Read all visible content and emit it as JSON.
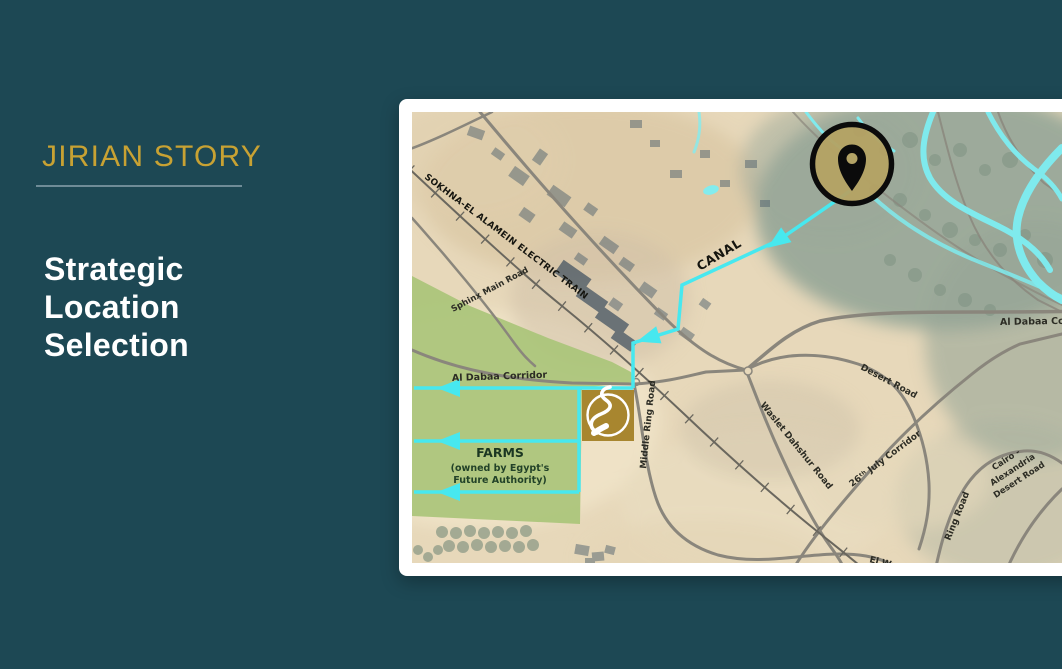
{
  "slide": {
    "kicker": "JIRIAN STORY",
    "title": "Strategic Location Selection"
  },
  "map": {
    "roads": {
      "railway": "SOKHNA-EL ALAMEIN ELECTRIC TRAIN",
      "sphinx": "Sphinx Main Road",
      "al_dabaa_mid": "Al Dabaa Corridor",
      "al_dabaa_right": "Al Dabaa Corridor",
      "middle_ring": "Middle Ring Road",
      "desert": "Desert Road",
      "waslet": "Waslet Dahshur Road",
      "july26": "26ᵗʰ July Corridor",
      "ring": "Ring Road",
      "el_wa": "El Wa",
      "cairo_alex_1": "Cairo -",
      "cairo_alex_2": "Alexandria",
      "cairo_alex_3": "Desert Road"
    },
    "water": {
      "canal": "CANAL"
    },
    "farms": {
      "title": "FARMS",
      "sub1": "(owned by Egypt's",
      "sub2": "Future Authority)"
    }
  },
  "colors": {
    "background": "#1d4854",
    "accent_gold": "#c8a233",
    "underline": "#7e99a3",
    "canal_cyan": "#47e8ef",
    "farm_green": "#a9c478",
    "logo_gold": "#a8862f",
    "pin_fill": "#b4a263"
  }
}
